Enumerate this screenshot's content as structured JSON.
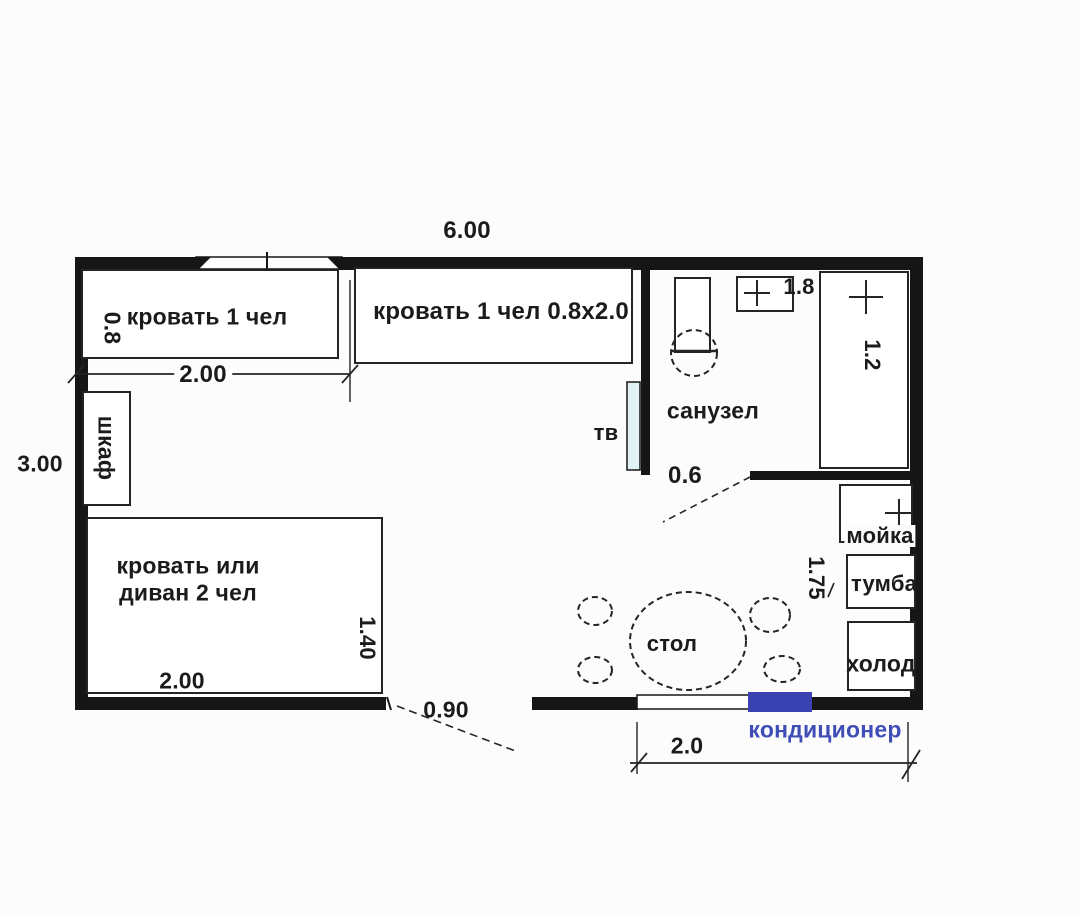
{
  "plan": {
    "type": "floor-plan",
    "room_label": "санузел",
    "colors": {
      "wall": "#161616",
      "furniture_stroke": "#242424",
      "tv_fill": "#e2f3f6",
      "ac_fill": "#3a42b2",
      "ac_text": "#3f4db6"
    }
  },
  "labels": {
    "overall_width": "6.00",
    "overall_height": "3.00",
    "bed1": "кровать 1 чел",
    "bed1_depth": "0.8",
    "bed1_width": "2.00",
    "bed2": "кровать 1 чел 0.8x2.0",
    "wardrobe": "шкаф",
    "sofa_line1": "кровать или",
    "sofa_line2": "диван 2 чел",
    "sofa_width": "2.00",
    "sofa_depth": "1.40",
    "tv": "тв",
    "bathroom": "санузел",
    "bath_sink_dim": "1.8",
    "shower_dim": "1.2",
    "bath_door_dim": "0.6",
    "kitchen_sink": "мойка",
    "cabinet": "тумба",
    "fridge": "холод",
    "kitchen_dim": "1.75",
    "table": "стол",
    "entry_door_dim": "0.90",
    "air_conditioner": "кондиционер",
    "window_dim": "2.0"
  }
}
